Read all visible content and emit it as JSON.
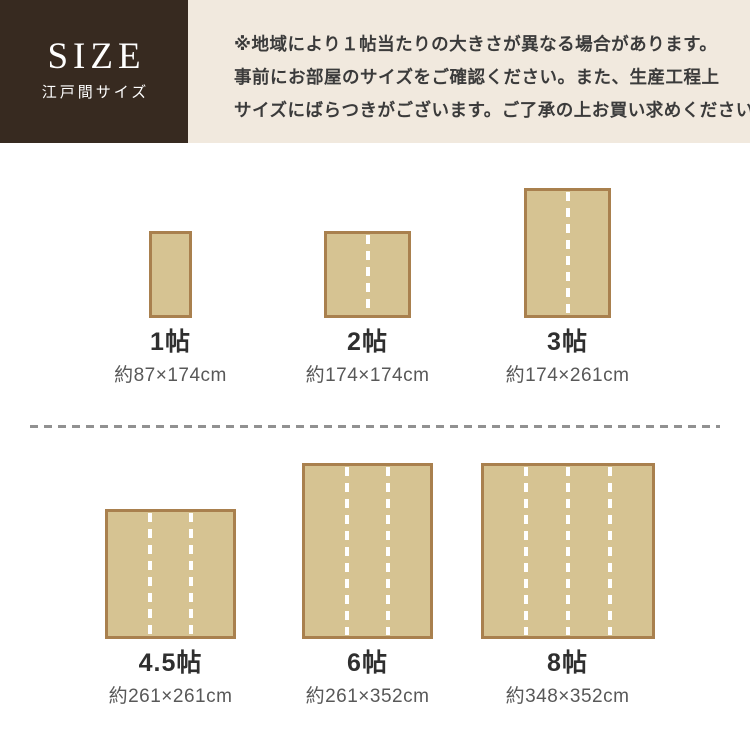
{
  "header": {
    "title": "SIZE",
    "subtitle": "江戸間サイズ",
    "note_lines": [
      "※地域により１帖当たりの大きさが異なる場合があります。",
      "事前にお部屋のサイズをご確認ください。また、生産工程上",
      "サイズにばらつきがございます。ご了承の上お買い求めください。"
    ],
    "colors": {
      "box_bg": "#372a20",
      "title_color": "#ffffff",
      "note_bg": "#f1e9de",
      "note_text": "#3b3b3b"
    }
  },
  "rugs": {
    "items": [
      {
        "label": "1帖",
        "size_text": "約87×174cm",
        "w_cm": 87,
        "h_cm": 174,
        "divider_lines": 0
      },
      {
        "label": "2帖",
        "size_text": "約174×174cm",
        "w_cm": 174,
        "h_cm": 174,
        "divider_lines": 1
      },
      {
        "label": "3帖",
        "size_text": "約174×261cm",
        "w_cm": 174,
        "h_cm": 261,
        "divider_lines": 1
      },
      {
        "label": "4.5帖",
        "size_text": "約261×261cm",
        "w_cm": 261,
        "h_cm": 261,
        "divider_lines": 2
      },
      {
        "label": "6帖",
        "size_text": "約261×352cm",
        "w_cm": 261,
        "h_cm": 352,
        "divider_lines": 2
      },
      {
        "label": "8帖",
        "size_text": "約348×352cm",
        "w_cm": 348,
        "h_cm": 352,
        "divider_lines": 3
      }
    ],
    "colors": {
      "fill": "#d6c392",
      "border": "#a9804e",
      "dash": "#ffffff"
    }
  },
  "divider": {
    "color": "#919191"
  }
}
